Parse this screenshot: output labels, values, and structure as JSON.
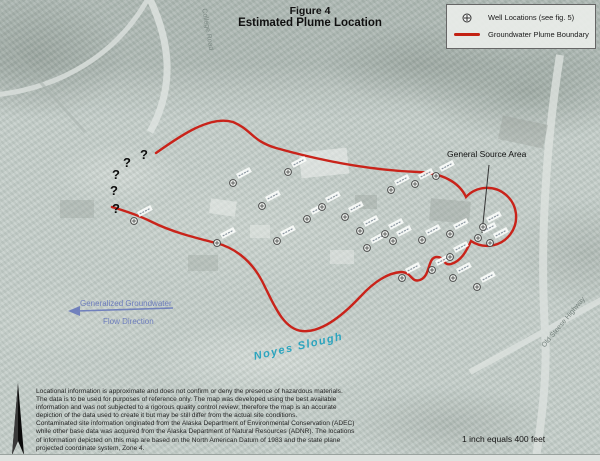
{
  "title": {
    "line1": "Figure 4",
    "line2": "Estimated Plume Location"
  },
  "legend": {
    "well_label": "Well Locations (see fig. 5)",
    "plume_label": "Groundwater Plume Boundary",
    "plume_color": "#c32113"
  },
  "map_labels": {
    "source_area": "General Source Area",
    "flow_line1": "Generalized Groundwater",
    "flow_line2": "Flow Direction",
    "slough": "Noyes Slough",
    "road_left": "College Road",
    "road_right": "Old Steese Highway",
    "question_mark": "?"
  },
  "scale_note": "1 inch equals 400 feet",
  "disclaimer": {
    "lines": [
      "Locational information is approximate and does not confirm or deny the presence of hazardous materials.",
      "The data is to be used for purposes of reference only.  The map was developed using the best available",
      "information and was not subjected to a rigorous quality control review; therefore the map is an accurate",
      "depiction of the data used to create it but may be still differ from the actual site conditions.",
      "Contaminated site information originated from the Alaska Department of Environmental Conservation (ADEC)",
      "while other base data was acquired from the Alaska Department of Natural Resources (ADNR).  The locations",
      "of information depicted on this map are based on the North American Datum of 1983 and the state plane",
      "projected coordinate system, Zone 4."
    ]
  },
  "plume": {
    "color": "#c9231a",
    "path_d": "M 156 153 C 180 136 210 115 233 122 C 252 130 252 141 276 148 C 322 161 368 170 418 172 C 442 173 459 182 466 197 A 29 29 0 1 1 471 241 C 466 252 461 261 451 264 C 443 266 445 257 437 257 C 427 257 431 276 420 280 C 411 283 412 272 401 272 C 386 273 372 284 360 297 C 344 314 322 333 302 331 C 282 329 272 300 262 281 C 250 258 232 247 216 243 C 196 238 172 232 152 222 C 136 214 122 210 112 207"
  },
  "leader_line": {
    "x1": 489,
    "y1": 165,
    "x2": 482,
    "y2": 233
  },
  "flow_arrow": {
    "x1": 173,
    "y1": 308,
    "x2": 72,
    "y2": 311,
    "color": "#6374bb"
  },
  "question_marks": [
    {
      "x": 140,
      "y": 147
    },
    {
      "x": 123,
      "y": 155
    },
    {
      "x": 112,
      "y": 167
    },
    {
      "x": 110,
      "y": 183
    },
    {
      "x": 112,
      "y": 201
    }
  ],
  "wells": [
    {
      "x": 134,
      "y": 221
    },
    {
      "x": 217,
      "y": 243
    },
    {
      "x": 233,
      "y": 183
    },
    {
      "x": 262,
      "y": 206
    },
    {
      "x": 277,
      "y": 241
    },
    {
      "x": 288,
      "y": 172
    },
    {
      "x": 307,
      "y": 219
    },
    {
      "x": 322,
      "y": 207
    },
    {
      "x": 345,
      "y": 217
    },
    {
      "x": 360,
      "y": 231
    },
    {
      "x": 367,
      "y": 248
    },
    {
      "x": 385,
      "y": 234
    },
    {
      "x": 393,
      "y": 241
    },
    {
      "x": 391,
      "y": 190
    },
    {
      "x": 402,
      "y": 278
    },
    {
      "x": 415,
      "y": 184
    },
    {
      "x": 422,
      "y": 240
    },
    {
      "x": 432,
      "y": 270
    },
    {
      "x": 436,
      "y": 176
    },
    {
      "x": 450,
      "y": 234
    },
    {
      "x": 450,
      "y": 257
    },
    {
      "x": 453,
      "y": 278
    },
    {
      "x": 477,
      "y": 287
    },
    {
      "x": 478,
      "y": 238
    },
    {
      "x": 483,
      "y": 227
    },
    {
      "x": 490,
      "y": 243
    }
  ]
}
